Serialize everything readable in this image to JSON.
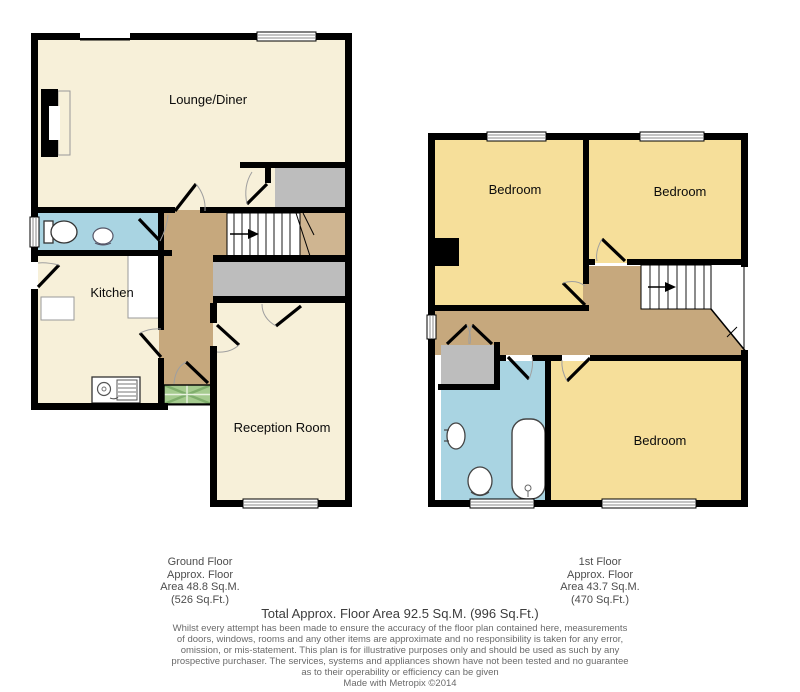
{
  "ground_floor": {
    "labels": {
      "lounge": "Lounge/Diner",
      "kitchen": "Kitchen",
      "reception": "Reception Room"
    },
    "caption": [
      "Ground Floor",
      "Approx. Floor",
      "Area 48.8 Sq.M.",
      "(526 Sq.Ft.)"
    ]
  },
  "first_floor": {
    "labels": {
      "bedroom1": "Bedroom",
      "bedroom2": "Bedroom",
      "bedroom3": "Bedroom"
    },
    "caption": [
      "1st Floor",
      "Approx. Floor",
      "Area 43.7 Sq.M.",
      "(470 Sq.Ft.)"
    ]
  },
  "footer": {
    "total": "Total Approx. Floor Area 92.5 Sq.M. (996 Sq.Ft.)",
    "disclaimer": [
      "Whilst every attempt has been made to ensure the accuracy of the floor plan contained here, measurements",
      "of doors, windows, rooms and any other items are approximate and no responsibility is taken for any error,",
      "omission, or mis-statement. This plan is for illustrative purposes only and should be used as such by any",
      "prospective purchaser. The services, systems and appliances shown have not been tested and no guarantee",
      "as to their operability or efficiency can be given"
    ],
    "credit": "Made with Metropix ©2014"
  },
  "colors": {
    "room_cream": "#f7f0d9",
    "room_yellow": "#f6df9a",
    "room_blue": "#a9d4e2",
    "hall_brown": "#c6a87d",
    "hall_tan": "#cfb591",
    "storage_gray": "#bdbdbd",
    "porch_green": "#a5cb8f",
    "wall": "#000000"
  }
}
